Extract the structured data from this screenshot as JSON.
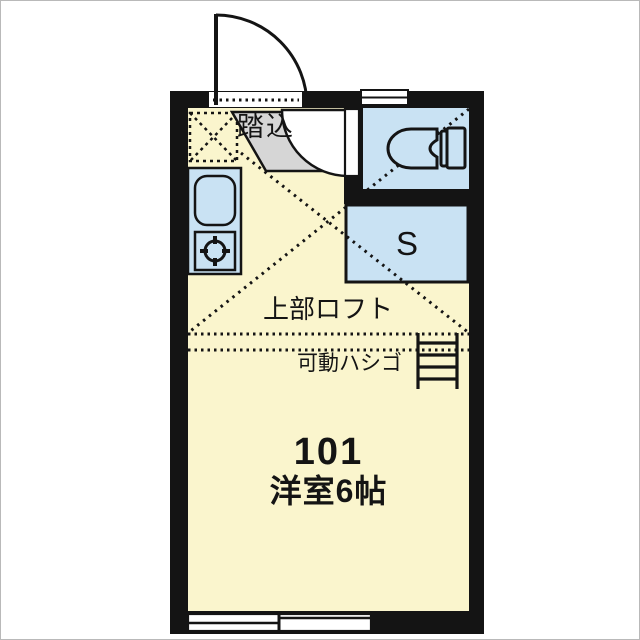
{
  "floorplan": {
    "labels": {
      "entrance": "踏込",
      "storage": "S",
      "loft": "上部ロフト",
      "ladder": "可動ハシゴ",
      "unit_number": "101",
      "room_type": "洋室6帖"
    },
    "colors": {
      "wall": "#141414",
      "room_fill": "#FAF5CD",
      "water_fill": "#C9E2F3",
      "entrance_fill": "#D6D6D6",
      "background": "#FFFFFF"
    }
  }
}
